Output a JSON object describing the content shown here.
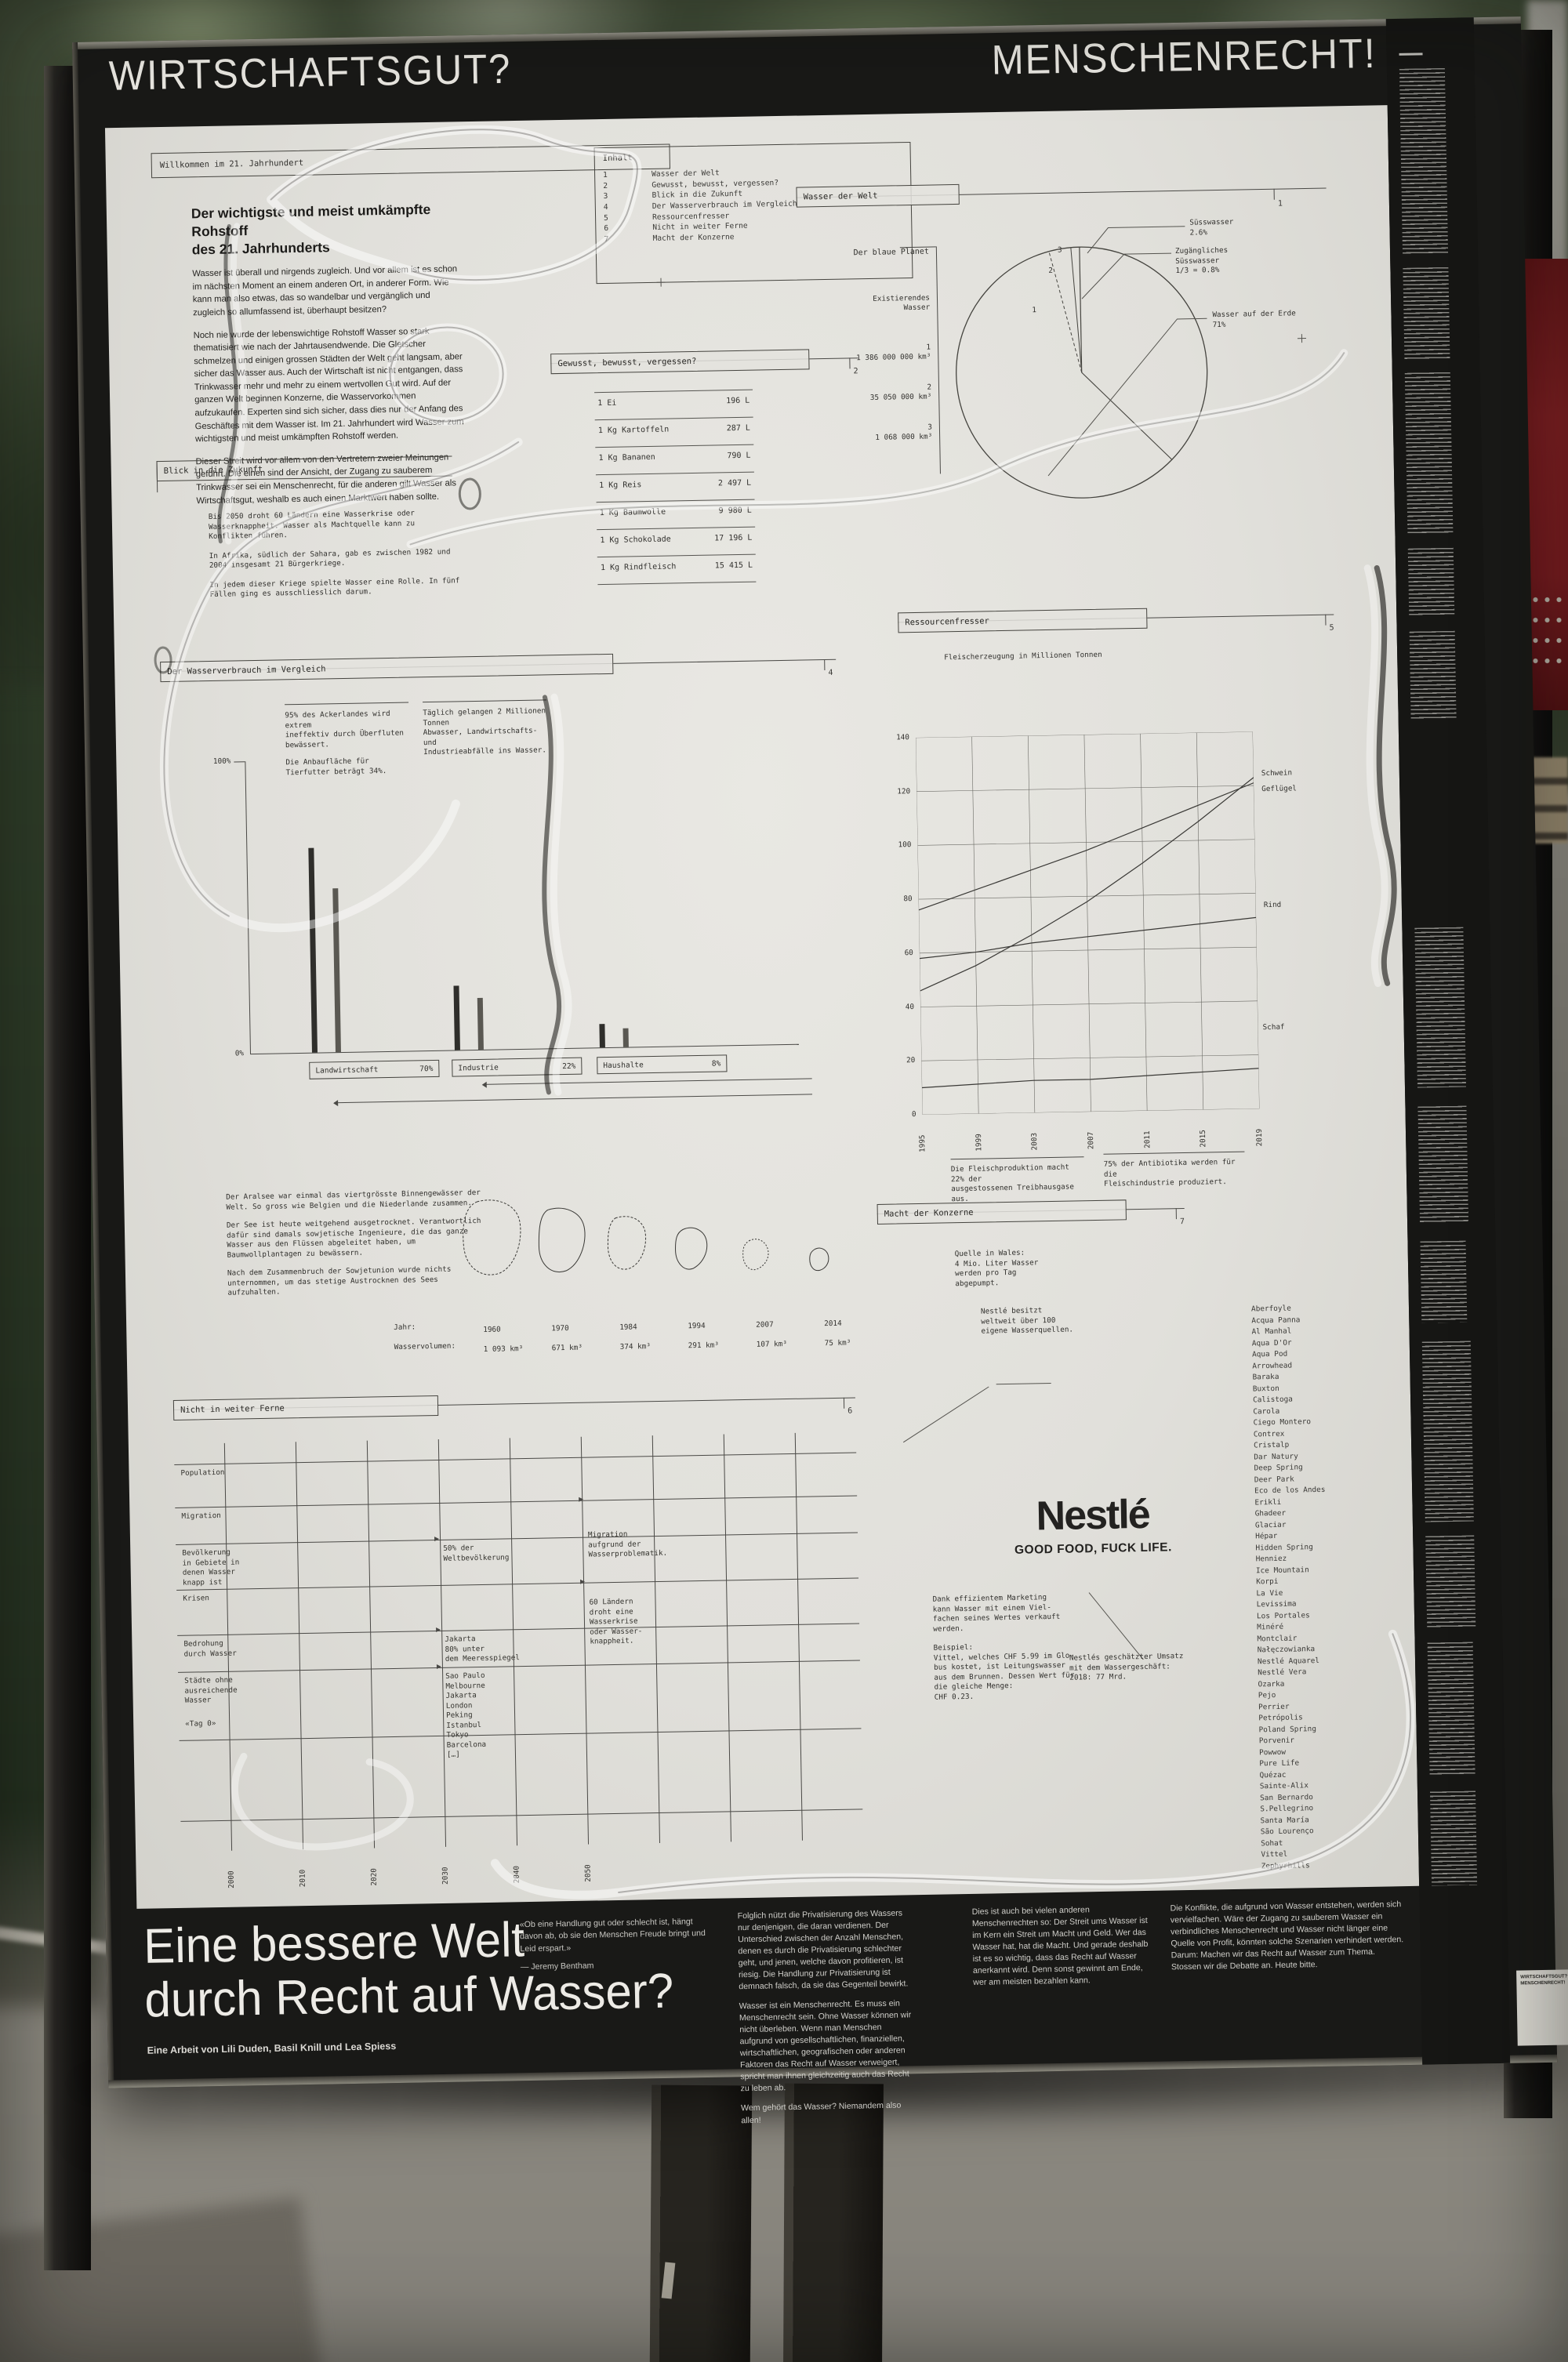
{
  "banner": {
    "left": "WIRTSCHAFTSGUT?",
    "right": "MENSCHENRECHT!"
  },
  "poster": {
    "welcome": "Willkommen im 21. Jahrhundert",
    "intro": {
      "title": "Der wichtigste und meist umkämpfte Rohstoff\ndes 21. Jahrhunderts",
      "p1": "Wasser ist überall und nirgends zugleich. Und vor allem ist es schon im nächsten Moment an einem anderen Ort, in anderer Form. Wie kann man also etwas, das so wandelbar und vergänglich und zugleich so allumfassend ist, überhaupt besitzen?",
      "p2": "Noch nie wurde der lebenswichtige Rohstoff Wasser so stark thematisiert wie nach der Jahrtausendwende. Die Gletscher schmelzen und einigen grossen Städten der Welt geht langsam, aber sicher das Wasser aus. Auch der Wirtschaft ist nicht entgangen, dass Trinkwasser mehr und mehr zu einem wertvollen Gut wird. Auf der ganzen Welt beginnen Konzerne, die Wasservorkommen aufzukaufen. Experten sind sich sicher, dass dies nur der Anfang des Geschäftes mit dem Wasser ist. Im 21. Jahrhundert wird Wasser zum wichtigsten und meist umkämpften Rohstoff werden.",
      "p3": "Dieser Streit wird vor allem von den Vertretern zweier Meinungen geführt. Die einen sind der Ansicht, der Zugang zu sauberem Trinkwasser sei ein Menschenrecht, für die anderen gilt Wasser als Wirtschaftsgut, weshalb es auch einen Marktwert haben sollte."
    },
    "inhalt": {
      "label": "Inhalt",
      "items": [
        "Wasser der Welt",
        "Gewusst, bewusst, vergessen?",
        "Blick in die Zukunft",
        "Der Wasserverbrauch im Vergleich",
        "Ressourcenfresser",
        "Nicht in weiter Ferne",
        "Macht der Konzerne"
      ]
    },
    "wasser_welt": {
      "label": "Wasser der Welt",
      "number": "1",
      "scale_title": "Der blaue Planet",
      "scale_sub": "Existierendes\nWasser",
      "scale_items": [
        {
          "n": "1",
          "v": "1 386 000 000 km³"
        },
        {
          "n": "2",
          "v": "35 050 000 km³"
        },
        {
          "n": "3",
          "v": "1 068 000 km³"
        }
      ],
      "nums": [
        "1",
        "2",
        "3"
      ],
      "pie_labels": {
        "suesswasser": "Süsswasser\n2.6%",
        "zugaenglich": "Zugängliches\nSüsswasser\n1/3 = 0.8%",
        "erde": "Wasser auf der Erde\n71%"
      }
    },
    "gewusst": {
      "label": "Gewusst, bewusst, vergessen?",
      "number": "2",
      "rows": [
        {
          "item": "1 Ei",
          "value": "196 L"
        },
        {
          "item": "1 Kg Kartoffeln",
          "value": "287 L"
        },
        {
          "item": "1 Kg Bananen",
          "value": "790 L"
        },
        {
          "item": "1 Kg Reis",
          "value": "2 497 L"
        },
        {
          "item": "1 Kg Baumwolle",
          "value": "9 980 L"
        },
        {
          "item": "1 Kg Schokolade",
          "value": "17 196 L"
        },
        {
          "item": "1 Kg Rindfleisch",
          "value": "15 415 L"
        }
      ]
    },
    "blick": {
      "label": "Blick in die Zukunft",
      "number": "3",
      "p1": "Bis 2050 droht 60 Ländern eine Wasserkrise oder Wasserknappheit. Wasser als Machtquelle kann zu Konflikten führen.",
      "p2": "In Afrika, südlich der Sahara, gab es zwischen 1982 und 2004 insgesamt 21 Bürgerkriege.",
      "p3": "In jedem dieser Kriege spielte Wasser eine Rolle. In fünf Fällen ging es ausschliesslich darum."
    },
    "verbrauch": {
      "label": "Der Wasserverbrauch im Vergleich",
      "number": "4",
      "note1a": "95% des Ackerlandes wird extrem\nineffektiv durch Überfluten bewässert.",
      "note1b": "Die Anbaufläche für Tierfutter beträgt 34%.",
      "note2": "Täglich gelangen 2 Millionen Tonnen\nAbwasser, Landwirtschafts- und\nIndustrieabfälle ins Wasser.",
      "y_top": "100%",
      "y_bottom": "0%"
    },
    "ressourcen": {
      "label": "Ressourcenfresser",
      "number": "5",
      "subtitle": "Fleischerzeugung in Millionen Tonnen",
      "caption1": "Die Fleischproduktion macht 22% der\nausgestossenen Treibhausgase aus.",
      "caption2": "75% der Antibiotika werden für die\nFleischindustrie produziert."
    },
    "aralsee": {
      "p1": "Der Aralsee war einmal das viertgrösste Binnengewässer der Welt. So gross wie Belgien und die Niederlande zusammen.",
      "p2": "Der See ist heute weitgehend ausgetrocknet. Verantwortlich dafür sind damals sowjetische Ingenieure, die das ganze Wasser aus den Flüssen abgeleitet haben, um Baumwollplantagen zu bewässern.",
      "p3": "Nach dem Zusammenbruch der Sowjetunion wurde nichts unternommen, um das stetige Austrocknen des Sees aufzuhalten.",
      "jahr_label": "Jahr:",
      "vol_label": "Wasservolumen:",
      "years": [
        "1960",
        "1970",
        "1984",
        "1994",
        "2007",
        "2014"
      ],
      "volumes": [
        "1 093 km³",
        "671 km³",
        "374 km³",
        "291 km³",
        "107 km³",
        "75 km³"
      ]
    },
    "ferne": {
      "label": "Nicht in weiter Ferne",
      "number": "6",
      "rows": [
        "Population",
        "Migration",
        "Bevölkerung\nin Gebiete in\ndenen Wasser\nknapp ist",
        "Krisen",
        "Bedrohung\ndurch Wasser",
        "Städte ohne\nausreichende\nWasser",
        "«Tag 0»"
      ],
      "years": [
        "2000",
        "2010",
        "2020",
        "2030",
        "2040",
        "2050"
      ],
      "ann_a1": "50% der\nWeltbevölkerung",
      "ann_a2": "Jakarta\n80% unter\ndem Meeresspiegel",
      "ann_a3": "Sao Paulo\nMelbourne\nJakarta\nLondon\nPeking\nIstanbul\nTokyo\nBarcelona\n[…]",
      "ann_b1": "Migration\naufgrund der\nWasserproblematik.",
      "ann_b2": "60 Ländern\ndroht eine\nWasserkrise\noder Wasser-\nknappheit."
    },
    "konzerne": {
      "label": "Macht der Konzerne",
      "number": "7",
      "wales": "Quelle in Wales:\n4 Mio. Liter Wasser\nwerden pro Tag\nabgepumpt.",
      "quellen": "Nestlé besitzt\nweltweit über 100\neigene Wasserquellen.",
      "logo": "Nestlé",
      "slogan": "GOOD FOOD, FUCK LIFE.",
      "marketing": "Dank effizientem Marketing\nkann Wasser mit einem Viel-\nfachen seines Wertes verkauft\nwerden.",
      "beispiel": "Beispiel:\nVittel, welches CHF 5.99 im Glo-\nbus kostet, ist Leitungswasser\naus dem Brunnen. Dessen Wert für\ndie gleiche Menge:\nCHF 0.23.",
      "umsatz": "Nestlés geschätzter Umsatz\nmit dem Wassergeschäft:\n2018: 77 Mrd.",
      "brands": [
        "Aberfoyle",
        "Acqua Panna",
        "Al Manhal",
        "Aqua D'Or",
        "Aqua Pod",
        "Arrowhead",
        "Baraka",
        "Buxton",
        "Calistoga",
        "Carola",
        "Ciego Montero",
        "Contrex",
        "Cristalp",
        "Dar Natury",
        "Deep Spring",
        "Deer Park",
        "Eco de los Andes",
        "Erikli",
        "Ghadeer",
        "Glaciar",
        "Hépar",
        "Hidden Spring",
        "Henniez",
        "Ice Mountain",
        "Korpi",
        "La Vie",
        "Levissima",
        "Los Portales",
        "Minéré",
        "Montclair",
        "Nałęczowianka",
        "Nestlé Aquarel",
        "Nestlé Vera",
        "Ozarka",
        "Pejo",
        "Perrier",
        "Petrópolis",
        "Poland Spring",
        "Porvenir",
        "Powwow",
        "Pure Life",
        "Quézac",
        "Sainte-Alix",
        "San Bernardo",
        "S.Pellegrino",
        "Santa María",
        "São Lourenço",
        "Sohat",
        "Vittel",
        "Zephyrhills"
      ]
    }
  },
  "bottom": {
    "headline": "Eine bessere Welt\ndurch Recht auf Wasser?",
    "credit": "Eine Arbeit von Lili Duden, Basil Knill und Lea Spiess",
    "quote": "«Ob eine Handlung gut oder schlecht ist, hängt davon ab, ob sie den Menschen Freude bringt und Leid erspart.»",
    "quote_attrib": "— Jeremy Bentham",
    "col1a": "Folglich nützt die Privatisierung des Wassers nur denjenigen, die daran verdienen. Der Unterschied zwischen der Anzahl Menschen, denen es durch die Privatisierung schlechter geht, und jenen, welche davon profitieren, ist riesig. Die Handlung zur Privatisierung ist demnach falsch, da sie das Gegenteil bewirkt.",
    "col1b": "Wasser ist ein Menschenrecht. Es muss ein Menschenrecht sein. Ohne Wasser können wir nicht überleben. Wenn man Menschen aufgrund von gesellschaftlichen, finanziellen, wirtschaftlichen, geografischen oder anderen Faktoren das Recht auf Wasser verweigert, spricht man ihnen gleichzeitig auch das Recht zu leben ab.",
    "col1c": "Wem gehört das Wasser? Niemandem also allen!",
    "col2": "Dies ist auch bei vielen anderen Menschenrechten so: Der Streit ums Wasser ist im Kern ein Streit um Macht und Geld. Wer das Wasser hat, hat die Macht. Und gerade deshalb ist es so wichtig, dass das Recht auf Wasser anerkannt wird. Denn sonst gewinnt am Ende, wer am meisten bezahlen kann.",
    "col3": "Die Konflikte, die aufgrund von Wasser entstehen, werden sich vervielfachen. Wäre der Zugang zu sauberem Wasser ein verbindliches Menschenrecht und Wasser nicht länger eine Quelle von Profit, könnten solche Szenarien verhindert werden. Darum: Machen wir das Recht auf Wasser zum Thema. Stossen wir die Debatte an. Heute bitte."
  },
  "chart_data": [
    {
      "type": "pie",
      "title": "Wasser der Welt",
      "slices": [
        {
          "label": "Wasser auf der Erde",
          "value": 71
        },
        {
          "label": "Süsswasser",
          "value": 2.6
        },
        {
          "label": "Zugängliches Süsswasser",
          "value": 0.8
        }
      ],
      "volumes_km3": {
        "1": "1 386 000 000",
        "2": "35 050 000",
        "3": "1 068 000"
      }
    },
    {
      "type": "bar",
      "title": "Der Wasserverbrauch im Vergleich",
      "categories": [
        "Landwirtschaft",
        "Industrie",
        "Haushalte"
      ],
      "values": [
        70,
        22,
        8
      ],
      "ylabel": "%",
      "ylim": [
        0,
        100
      ]
    },
    {
      "type": "line",
      "title": "Fleischerzeugung in Millionen Tonnen",
      "x": [
        1995,
        1999,
        2003,
        2007,
        2011,
        2015,
        2019
      ],
      "series": [
        {
          "name": "Schwein",
          "values": [
            76,
            83,
            90,
            97,
            105,
            113,
            121
          ]
        },
        {
          "name": "Geflügel",
          "values": [
            46,
            55,
            66,
            78,
            92,
            107,
            123
          ]
        },
        {
          "name": "Rind",
          "values": [
            58,
            60,
            63,
            65,
            67,
            69,
            71
          ]
        },
        {
          "name": "Schaf",
          "values": [
            10,
            11,
            12,
            12,
            13,
            14,
            15
          ]
        }
      ],
      "ylim": [
        0,
        140
      ],
      "grid": true,
      "legend_position": "right"
    },
    {
      "type": "table",
      "title": "Aralsee — Wasservolumen",
      "categories": [
        "1960",
        "1970",
        "1984",
        "1994",
        "2007",
        "2014"
      ],
      "values": [
        1093,
        671,
        374,
        291,
        107,
        75
      ],
      "unit": "km³"
    },
    {
      "type": "table",
      "title": "Virtuelles Wasser pro Produkt",
      "categories": [
        "1 Ei",
        "1 Kg Kartoffeln",
        "1 Kg Bananen",
        "1 Kg Reis",
        "1 Kg Baumwolle",
        "1 Kg Schokolade",
        "1 Kg Rindfleisch"
      ],
      "values": [
        196,
        287,
        790,
        2497,
        9980,
        17196,
        15415
      ],
      "unit": "L"
    }
  ]
}
